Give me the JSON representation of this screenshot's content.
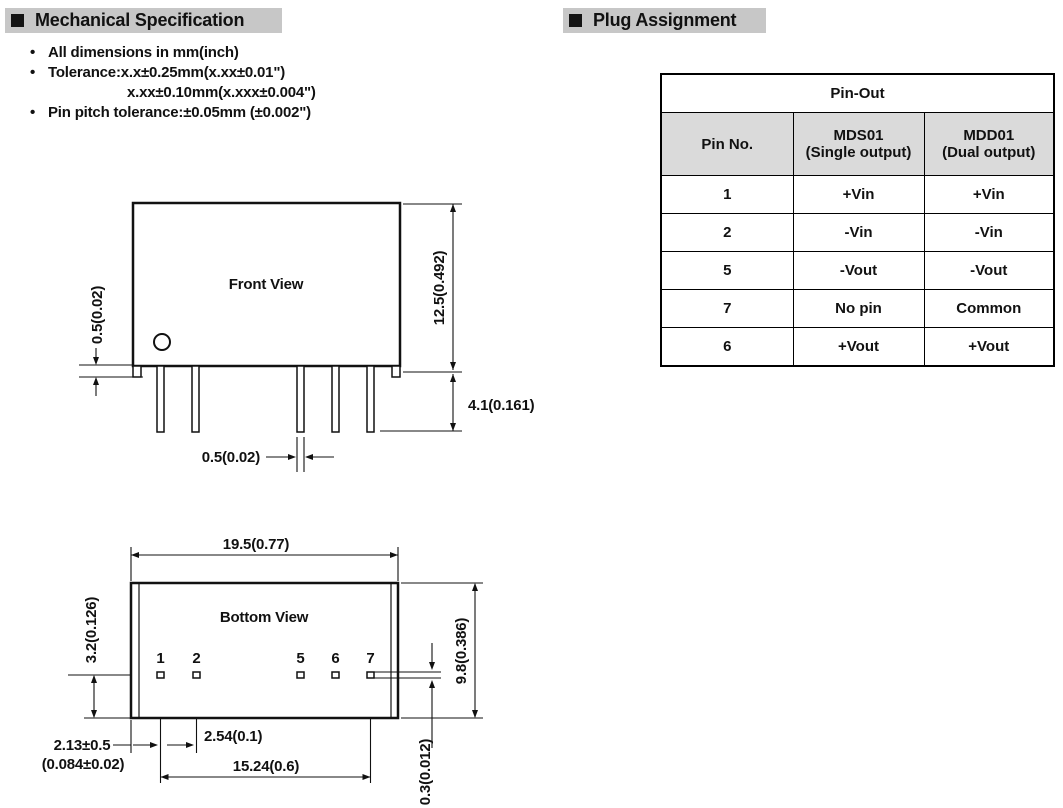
{
  "colors": {
    "page_bg": "#ffffff",
    "section_header_bg": "#c7c7c7",
    "table_header_bg": "#dadada",
    "line_color": "#111111"
  },
  "header_mechanical": {
    "title": "Mechanical Specification"
  },
  "header_plug": {
    "title": "Plug Assignment"
  },
  "notes": {
    "bullet": "•",
    "line1": "All dimensions in mm(inch)",
    "line2": "Tolerance:x.x±0.25mm(x.xx±0.01\")",
    "line3": "x.xx±0.10mm(x.xxx±0.004\")",
    "line4": "Pin pitch tolerance:±0.05mm (±0.002\")"
  },
  "front_view": {
    "title": "Front View",
    "dim_flange": "0.5(0.02)",
    "dim_height": "12.5(0.492)",
    "dim_pin_length": "4.1(0.161)",
    "dim_pin_width": "0.5(0.02)"
  },
  "bottom_view": {
    "title": "Bottom View",
    "dim_width": "19.5(0.77)",
    "dim_depth": "9.8(0.386)",
    "dim_pin_offset": "3.2(0.126)",
    "dim_pin1_a": "2.13±0.5",
    "dim_pin1_b": "(0.084±0.02)",
    "dim_pitch": "2.54(0.1)",
    "dim_span": "15.24(0.6)",
    "dim_pin_thickness": "0.3(0.012)",
    "pins": {
      "p1": "1",
      "p2": "2",
      "p5": "5",
      "p6": "6",
      "p7": "7"
    }
  },
  "pinout": {
    "title": "Pin-Out",
    "col_pin": "Pin No.",
    "col_mds_model": "MDS01",
    "col_mds_sub": "(Single output)",
    "col_mdd_model": "MDD01",
    "col_mdd_sub": "(Dual output)",
    "rows": [
      {
        "pin": "1",
        "mds": "+Vin",
        "mdd": "+Vin"
      },
      {
        "pin": "2",
        "mds": "-Vin",
        "mdd": "-Vin"
      },
      {
        "pin": "5",
        "mds": "-Vout",
        "mdd": "-Vout"
      },
      {
        "pin": "7",
        "mds": "No pin",
        "mdd": "Common"
      },
      {
        "pin": "6",
        "mds": "+Vout",
        "mdd": "+Vout"
      }
    ]
  }
}
